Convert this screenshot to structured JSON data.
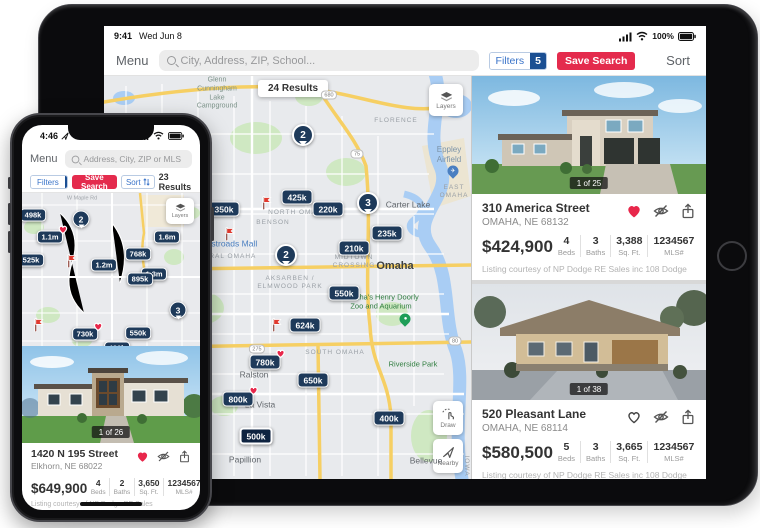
{
  "colors": {
    "pin_navy": "#1e3a5a",
    "selected_pin": "#0e2340",
    "save_red": "#e42b4d",
    "filter_blue": "#3a74c9",
    "badge_navy": "#1a4f93",
    "heart_red": "#e8274b"
  },
  "ipad": {
    "status": {
      "time": "9:41",
      "date": "Wed Jun 8",
      "battery": "100%"
    },
    "toolbar": {
      "menu": "Menu",
      "search_placeholder": "City, Address, ZIP, School...",
      "filters": "Filters",
      "filters_count": "5",
      "save_search": "Save Search",
      "sort": "Sort"
    },
    "map": {
      "results": "24 Results",
      "layers": "Layers",
      "draw": "Draw",
      "nearby": "Nearby",
      "pins": [
        {
          "price": "425k",
          "x": 193,
          "y": 121
        },
        {
          "price": "350k",
          "x": 120,
          "y": 133
        },
        {
          "price": "220k",
          "x": 224,
          "y": 133
        },
        {
          "price": "235k",
          "x": 283,
          "y": 157
        },
        {
          "price": "210k",
          "x": 250,
          "y": 172
        },
        {
          "price": "550k",
          "x": 240,
          "y": 217
        },
        {
          "price": "624k",
          "x": 201,
          "y": 249
        },
        {
          "price": "780k",
          "x": 161,
          "y": 286,
          "heart": true
        },
        {
          "price": "650k",
          "x": 209,
          "y": 304
        },
        {
          "price": "800k",
          "x": 134,
          "y": 323,
          "heart": true
        },
        {
          "price": "400k",
          "x": 285,
          "y": 342
        },
        {
          "price": "500k",
          "x": 152,
          "y": 360,
          "selected": true
        }
      ],
      "clusters": [
        {
          "n": "2",
          "x": 199,
          "y": 59
        },
        {
          "n": "3",
          "x": 264,
          "y": 127
        },
        {
          "n": "2",
          "x": 182,
          "y": 179
        }
      ],
      "flags": [
        {
          "x": 163,
          "y": 135
        },
        {
          "x": 126,
          "y": 166
        },
        {
          "x": 173,
          "y": 257
        }
      ],
      "labels": [
        {
          "text": "Glenn\nCunningham\nLake\nCampground",
          "x": 113,
          "y": 18,
          "t": "place"
        },
        {
          "text": "FLORENCE",
          "x": 292,
          "y": 45,
          "t": "area"
        },
        {
          "text": "Eppley\nAirfield",
          "x": 345,
          "y": 79,
          "t": "airport"
        },
        {
          "text": "Carter Lake",
          "x": 304,
          "y": 129,
          "t": "city"
        },
        {
          "text": "EAST OMAHA",
          "x": 350,
          "y": 116,
          "t": "area"
        },
        {
          "text": "NORTH OMAHA",
          "x": 194,
          "y": 137,
          "t": "area"
        },
        {
          "text": "BENSON",
          "x": 169,
          "y": 147,
          "t": "area"
        },
        {
          "text": "CENTRAL OMAHA",
          "x": 118,
          "y": 181,
          "t": "area"
        },
        {
          "text": "Westroads Mall",
          "x": 124,
          "y": 168,
          "t": "poiblue"
        },
        {
          "text": "MIDTOWN\nCROSSING",
          "x": 250,
          "y": 186,
          "t": "area"
        },
        {
          "text": "Omaha",
          "x": 291,
          "y": 191,
          "t": "bigcity"
        },
        {
          "text": "AKSARBEN /\nELMWOOD PARK",
          "x": 186,
          "y": 207,
          "t": "area"
        },
        {
          "text": "Omaha's Henry Doorly\nZoo and Aquarium",
          "x": 277,
          "y": 226,
          "t": "park"
        },
        {
          "text": "SOUTH OMAHA",
          "x": 231,
          "y": 277,
          "t": "area"
        },
        {
          "text": "Riverside Park",
          "x": 309,
          "y": 288,
          "t": "park"
        },
        {
          "text": "Ralston",
          "x": 150,
          "y": 299,
          "t": "city"
        },
        {
          "text": "La Vista",
          "x": 156,
          "y": 329,
          "t": "city"
        },
        {
          "text": "Papillion",
          "x": 141,
          "y": 384,
          "t": "city"
        },
        {
          "text": "Bellevue",
          "x": 322,
          "y": 385,
          "t": "city"
        },
        {
          "text": "IOWA",
          "x": 362,
          "y": 390,
          "t": "vert"
        }
      ],
      "poi_pins": [
        {
          "kind": "airport",
          "x": 349,
          "y": 95
        },
        {
          "kind": "zoo",
          "x": 301,
          "y": 243
        }
      ],
      "shields": [
        {
          "t": "680",
          "x": 225,
          "y": 19
        },
        {
          "t": "75",
          "x": 253,
          "y": 78
        },
        {
          "t": "275",
          "x": 153,
          "y": 273
        },
        {
          "t": "80",
          "x": 351,
          "y": 265
        }
      ]
    },
    "cards": [
      {
        "address": "310 America Street",
        "city": "OMAHA, NE 68132",
        "price": "$424,900",
        "photo_badge": "1 of 25",
        "favorited": true,
        "stats": [
          {
            "v": "4",
            "l": "Beds"
          },
          {
            "v": "3",
            "l": "Baths"
          },
          {
            "v": "3,388",
            "l": "Sq. Ft."
          },
          {
            "v": "1234567",
            "l": "MLS#"
          }
        ],
        "courtesy": "Listing courtesy of NP Dodge RE Sales inc 108 Dodge"
      },
      {
        "address": "520 Pleasant Lane",
        "city": "OMAHA, NE 68114",
        "price": "$580,500",
        "photo_badge": "1 of 38",
        "favorited": false,
        "stats": [
          {
            "v": "5",
            "l": "Beds"
          },
          {
            "v": "3",
            "l": "Baths"
          },
          {
            "v": "3,665",
            "l": "Sq. Ft."
          },
          {
            "v": "1234567",
            "l": "MLS#"
          }
        ],
        "courtesy": "Listing courtesy of NP Dodge RE Sales inc 108 Dodge"
      }
    ]
  },
  "iphone": {
    "status": {
      "time": "4:46"
    },
    "toolbar": {
      "menu": "Menu",
      "search_placeholder": "Address, City, ZIP or MLS",
      "filters": "Filters",
      "filters_count": "5",
      "save_search": "Save Search",
      "sort": "Sort",
      "results": "23 Results"
    },
    "map": {
      "layers": "Layers",
      "street": "W Maple Rd",
      "pins": [
        {
          "price": "498k",
          "x": 11,
          "y": 22
        },
        {
          "price": "1.1m",
          "x": 28,
          "y": 44,
          "heart": true
        },
        {
          "price": "1.6m",
          "x": 145,
          "y": 44
        },
        {
          "price": "525k",
          "x": 9,
          "y": 67
        },
        {
          "price": "768k",
          "x": 116,
          "y": 61
        },
        {
          "price": "1.2m",
          "x": 82,
          "y": 72
        },
        {
          "price": "1.3m",
          "x": 132,
          "y": 81
        },
        {
          "price": "895k",
          "x": 118,
          "y": 86
        },
        {
          "price": "730k",
          "x": 63,
          "y": 141,
          "heart": true
        },
        {
          "price": "550k",
          "x": 116,
          "y": 140
        },
        {
          "price": "430k",
          "x": 95,
          "y": 155
        }
      ],
      "clusters": [
        {
          "n": "2",
          "x": 59,
          "y": 26
        },
        {
          "n": "3",
          "x": 156,
          "y": 117
        }
      ],
      "flags": [
        {
          "x": 50,
          "y": 76
        },
        {
          "x": 17,
          "y": 140
        }
      ]
    },
    "card": {
      "address": "1420 N 195 Street",
      "city": "Elkhorn, NE 68022",
      "price": "$649,900",
      "photo_badge": "1 of 26",
      "favorited": true,
      "stats": [
        {
          "v": "4",
          "l": "Beds"
        },
        {
          "v": "2",
          "l": "Baths"
        },
        {
          "v": "3,650",
          "l": "Sq. Ft."
        },
        {
          "v": "1234567",
          "l": "MLS#"
        }
      ],
      "courtesy": "Listing courtesy of NP Dodge RE Sales"
    }
  }
}
